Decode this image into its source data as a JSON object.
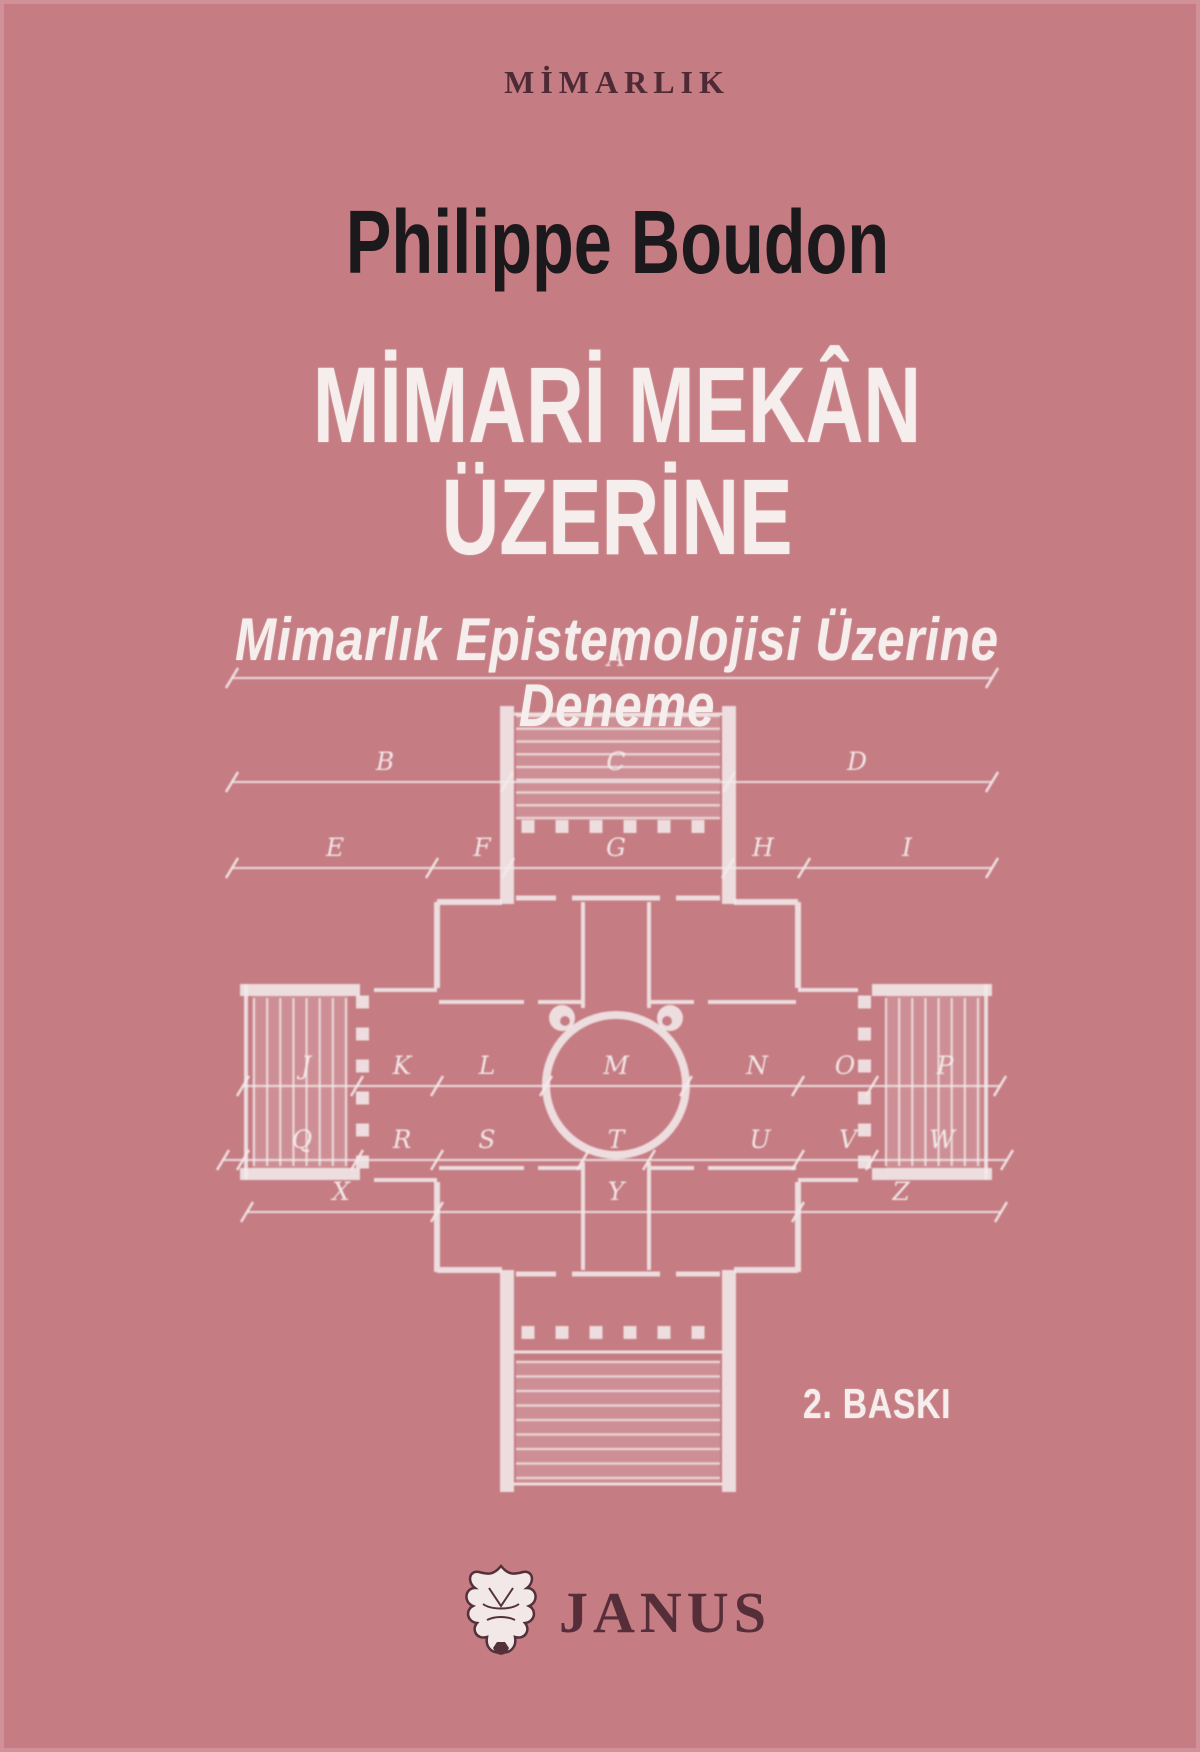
{
  "cover": {
    "series": "MİMARLIK",
    "author": "Philippe Boudon",
    "title": "MİMARİ MEKÂN ÜZERİNE",
    "subtitle": "Mimarlık Epistemolojisi Üzerine Deneme",
    "edition": "2. BASKI",
    "publisher": "JANUS"
  },
  "colors": {
    "background": "#c57c83",
    "light_text": "#f5eeec",
    "dark_text": "#1b191c",
    "series_text": "#4e2a35",
    "publisher_text": "#562e39",
    "drawing_lines": "#f3eaea"
  },
  "drawing": {
    "type": "architectural-floor-plan",
    "subject": "villa plan with central circular hall, four porticos with steps, and lettered dimension lines",
    "dimension_rows": [
      {
        "y": 678,
        "x1": 232,
        "x2": 992,
        "ticks": [],
        "labels": [
          {
            "t": "A",
            "x": 616
          }
        ]
      },
      {
        "y": 782,
        "x1": 232,
        "x2": 992,
        "ticks": [
          507,
          729
        ],
        "labels": [
          {
            "t": "B",
            "x": 385
          },
          {
            "t": "C",
            "x": 616
          },
          {
            "t": "D",
            "x": 857
          }
        ]
      },
      {
        "y": 868,
        "x1": 232,
        "x2": 992,
        "ticks": [
          432,
          508,
          728,
          804
        ],
        "labels": [
          {
            "t": "E",
            "x": 335
          },
          {
            "t": "F",
            "x": 482
          },
          {
            "t": "G",
            "x": 616
          },
          {
            "t": "H",
            "x": 763
          },
          {
            "t": "I",
            "x": 907
          }
        ]
      },
      {
        "y": 1086,
        "x1": 243,
        "x2": 1000,
        "ticks": [
          357,
          437,
          546,
          686,
          798,
          872
        ],
        "labels": [
          {
            "t": "J",
            "x": 306
          },
          {
            "t": "K",
            "x": 402
          },
          {
            "t": "L",
            "x": 487
          },
          {
            "t": "M",
            "x": 616
          },
          {
            "t": "N",
            "x": 757
          },
          {
            "t": "O",
            "x": 845
          },
          {
            "t": "P",
            "x": 945
          }
        ]
      },
      {
        "y": 1160,
        "x1": 223,
        "x2": 1007,
        "ticks": [
          243,
          357,
          437,
          583,
          649,
          798,
          872
        ],
        "labels": [
          {
            "t": "Q",
            "x": 302
          },
          {
            "t": "R",
            "x": 402
          },
          {
            "t": "S",
            "x": 487
          },
          {
            "t": "T",
            "x": 616
          },
          {
            "t": "U",
            "x": 760
          },
          {
            "t": "V",
            "x": 848
          },
          {
            "t": "W",
            "x": 942
          }
        ]
      },
      {
        "y": 1212,
        "x1": 247,
        "x2": 1001,
        "ticks": [
          437,
          798
        ],
        "labels": [
          {
            "t": "X",
            "x": 341
          },
          {
            "t": "Y",
            "x": 616
          },
          {
            "t": "Z",
            "x": 901
          }
        ]
      }
    ]
  }
}
